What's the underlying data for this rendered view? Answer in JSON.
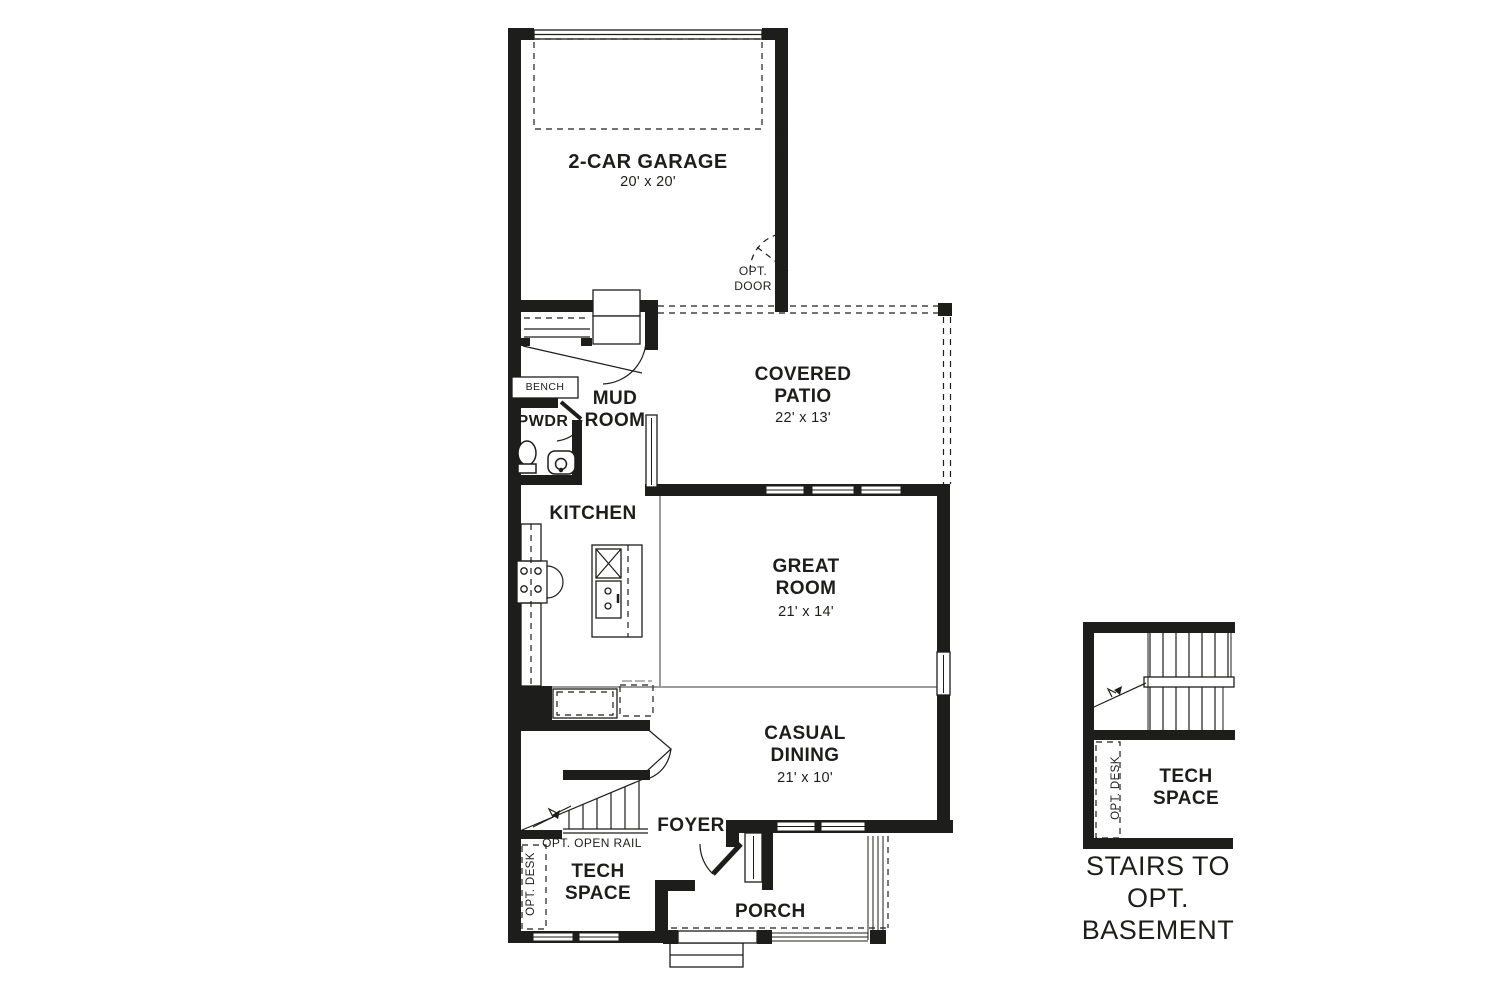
{
  "colors": {
    "ink": "#1d1d1b",
    "background": "#ffffff"
  },
  "plan": {
    "rooms": {
      "garage": {
        "label": "2-CAR GARAGE",
        "dims": "20' x 20'"
      },
      "covered_patio": {
        "label": "COVERED PATIO",
        "dims": "22' x 13'"
      },
      "mud_room": {
        "label": "MUD ROOM"
      },
      "powder": {
        "label": "PWDR"
      },
      "kitchen": {
        "label": "KITCHEN"
      },
      "great_room": {
        "label": "GREAT ROOM",
        "dims": "21' x 14'"
      },
      "casual_dining": {
        "label": "CASUAL DINING",
        "dims": "21' x 10'"
      },
      "foyer": {
        "label": "FOYER"
      },
      "tech_space": {
        "label": "TECH SPACE"
      },
      "porch": {
        "label": "PORCH"
      }
    },
    "annotations": {
      "garage_options": "GARAGE OPTIONS AVAILABLE",
      "opt_door": "OPT. DOOR",
      "bench": "BENCH",
      "opt_open_rail": "OPT. OPEN RAIL",
      "opt_desk": "OPT. DESK"
    }
  },
  "detail": {
    "tech_space_label": "TECH SPACE",
    "opt_desk": "OPT. DESK",
    "caption": "STAIRS TO OPT. BASEMENT"
  }
}
